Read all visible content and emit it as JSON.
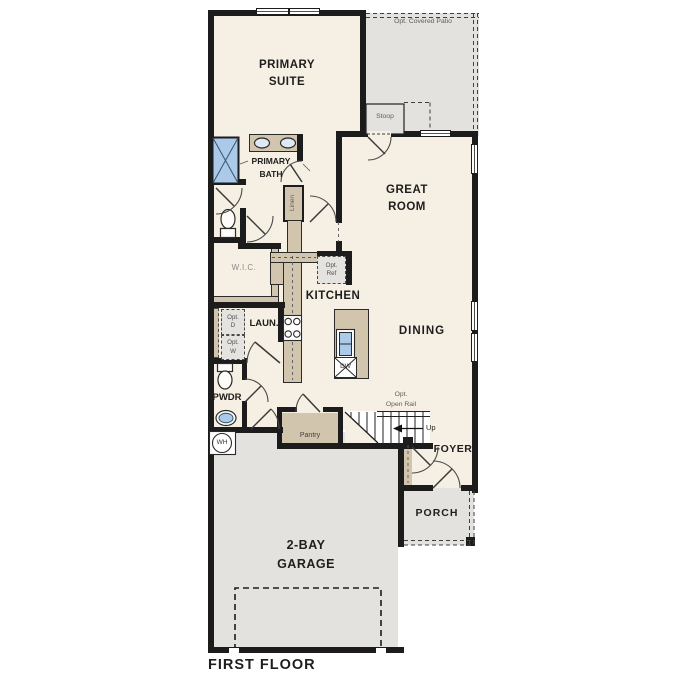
{
  "plan_title": "FIRST FLOOR",
  "colors": {
    "floor_cream": "#f6efe4",
    "concrete_gray": "#e3e2df",
    "cabinet_tan": "#d2c5ae",
    "fixture_blue": "#abc9e8",
    "wall_black": "#1c1c1c"
  },
  "rooms": {
    "primary_suite": "PRIMARY\nSUITE",
    "opt_covered_patio": "Opt. Covered Patio",
    "stoop": "Stoop",
    "primary_bath": "PRIMARY\nBATH",
    "linen": "Linen",
    "wic": "W.I.C.",
    "great_room": "GREAT\nROOM",
    "kitchen": "KITCHEN",
    "dining": "DINING",
    "laundry": "LAUN.",
    "powder": "PWDR",
    "pantry": "Pantry",
    "foyer": "FOYER",
    "porch": "PORCH",
    "garage": "2-BAY\nGARAGE"
  },
  "fixtures": {
    "opt_refrigerator": "Opt.\nRef",
    "opt_dryer": "Opt.\nD",
    "opt_washer": "Opt.\nW",
    "dishwasher": "DW",
    "water_heater": "WH"
  },
  "stairs": {
    "opt_open_rail": "Opt.\nOpen Rail",
    "direction": "Up"
  }
}
